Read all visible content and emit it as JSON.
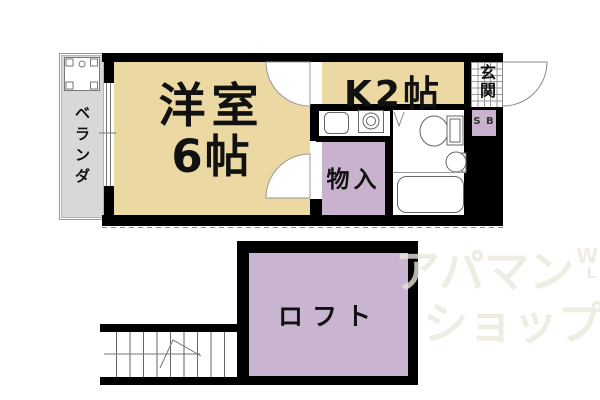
{
  "plan": {
    "veranda": "ベランダ",
    "western_room_name": "洋室",
    "western_room_size": "6帖",
    "kitchen": "K2帖",
    "entrance": "玄関",
    "storage": "物入",
    "shoe_box": "S B",
    "loft": "ロフト"
  },
  "watermark": {
    "line1": "アパマン",
    "line2": "ショップ",
    "mark_top": "W",
    "mark_bottom": "L"
  },
  "colors": {
    "room_beige": "#ebd8a2",
    "closet_purple": "#c8b2ce",
    "loft_purple": "#c9b5d1",
    "veranda_gray": "#d8d8d8",
    "wall_black": "#000000",
    "entrance_tile_line": "#999999",
    "watermark_gray": "#eae7df"
  }
}
